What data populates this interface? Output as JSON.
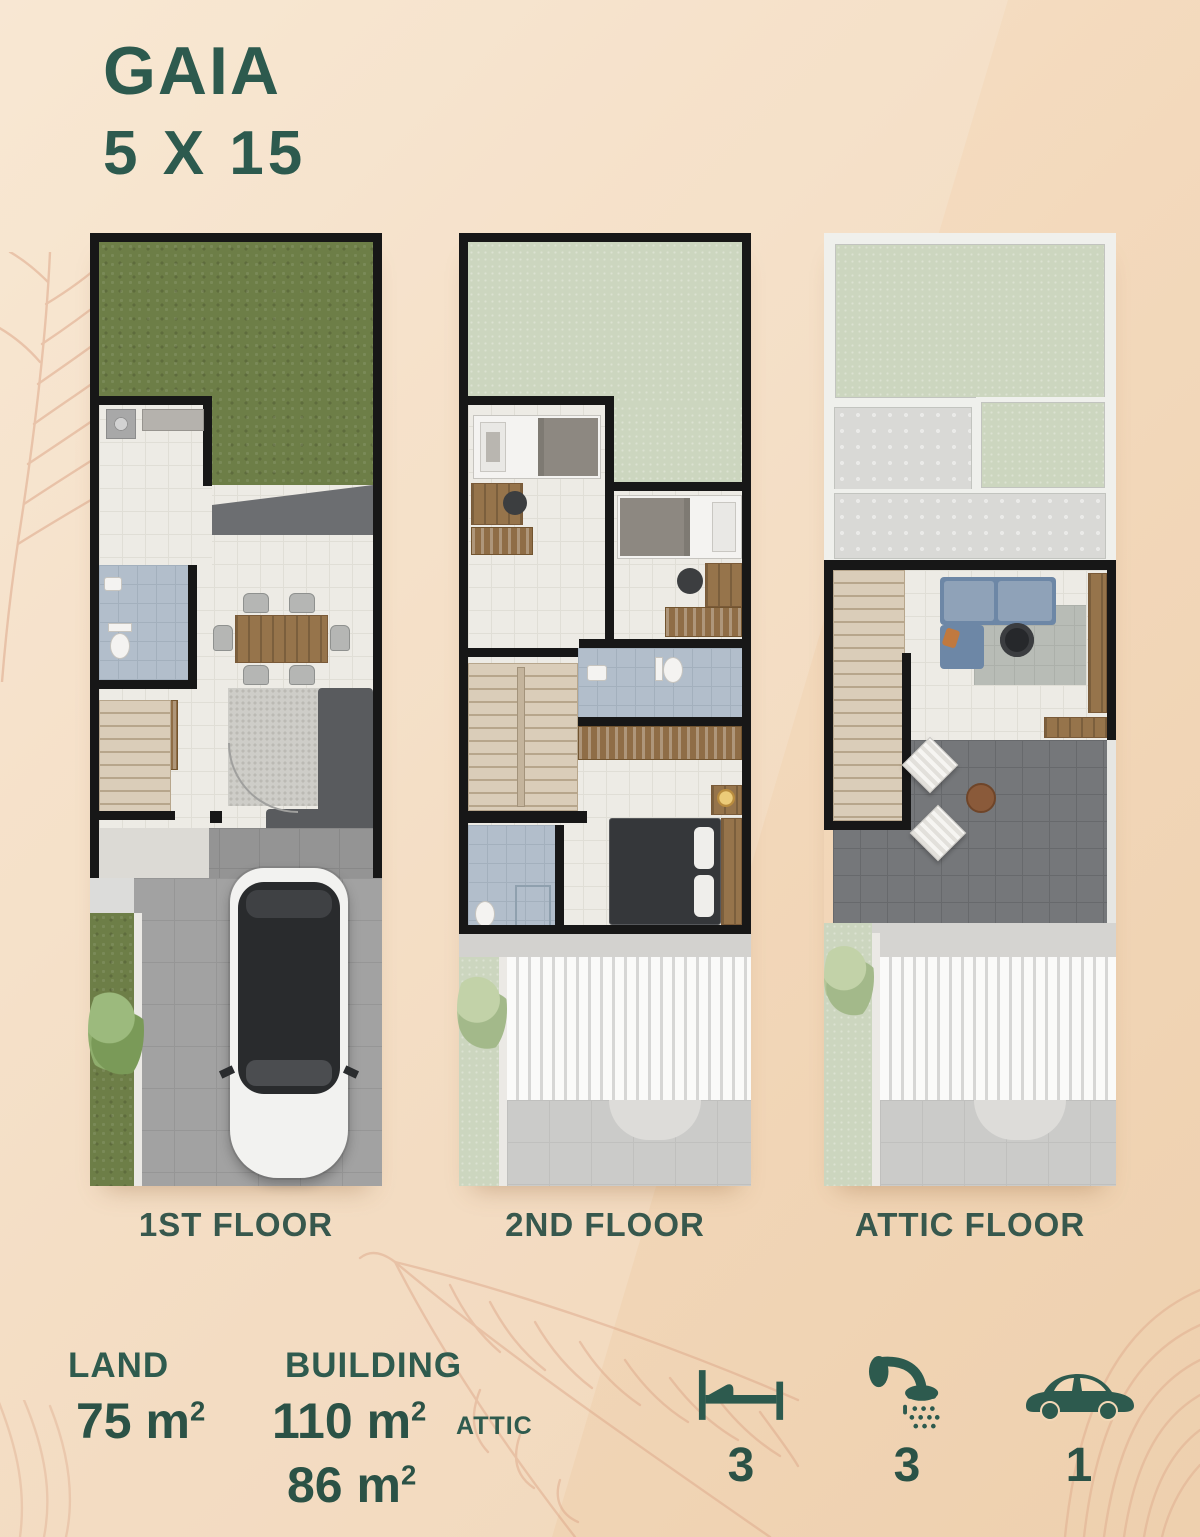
{
  "header": {
    "title": "GAIA",
    "subtitle": "5 X 15"
  },
  "floors": [
    {
      "label": "1ST FLOOR"
    },
    {
      "label": "2ND FLOOR"
    },
    {
      "label": "ATTIC FLOOR"
    }
  ],
  "specs": {
    "land": {
      "label": "LAND",
      "value": "75",
      "unit": "m",
      "sup": "2"
    },
    "building": {
      "label": "BUILDING",
      "value": "110",
      "unit": "m",
      "sup": "2"
    },
    "attic": {
      "label": "ATTIC",
      "value": "86",
      "unit": "m",
      "sup": "2"
    }
  },
  "amenities": [
    {
      "icon": "bed-icon",
      "count": "3"
    },
    {
      "icon": "shower-icon",
      "count": "3"
    },
    {
      "icon": "car-icon",
      "count": "1"
    }
  ],
  "colors": {
    "accent_green": "#2d5a4e",
    "background_peach": "#f3d9bc",
    "leaf_line": "#dca385",
    "grass": "#6d7e47",
    "roof_green": "#ccd6bf",
    "wall": "#171717"
  }
}
